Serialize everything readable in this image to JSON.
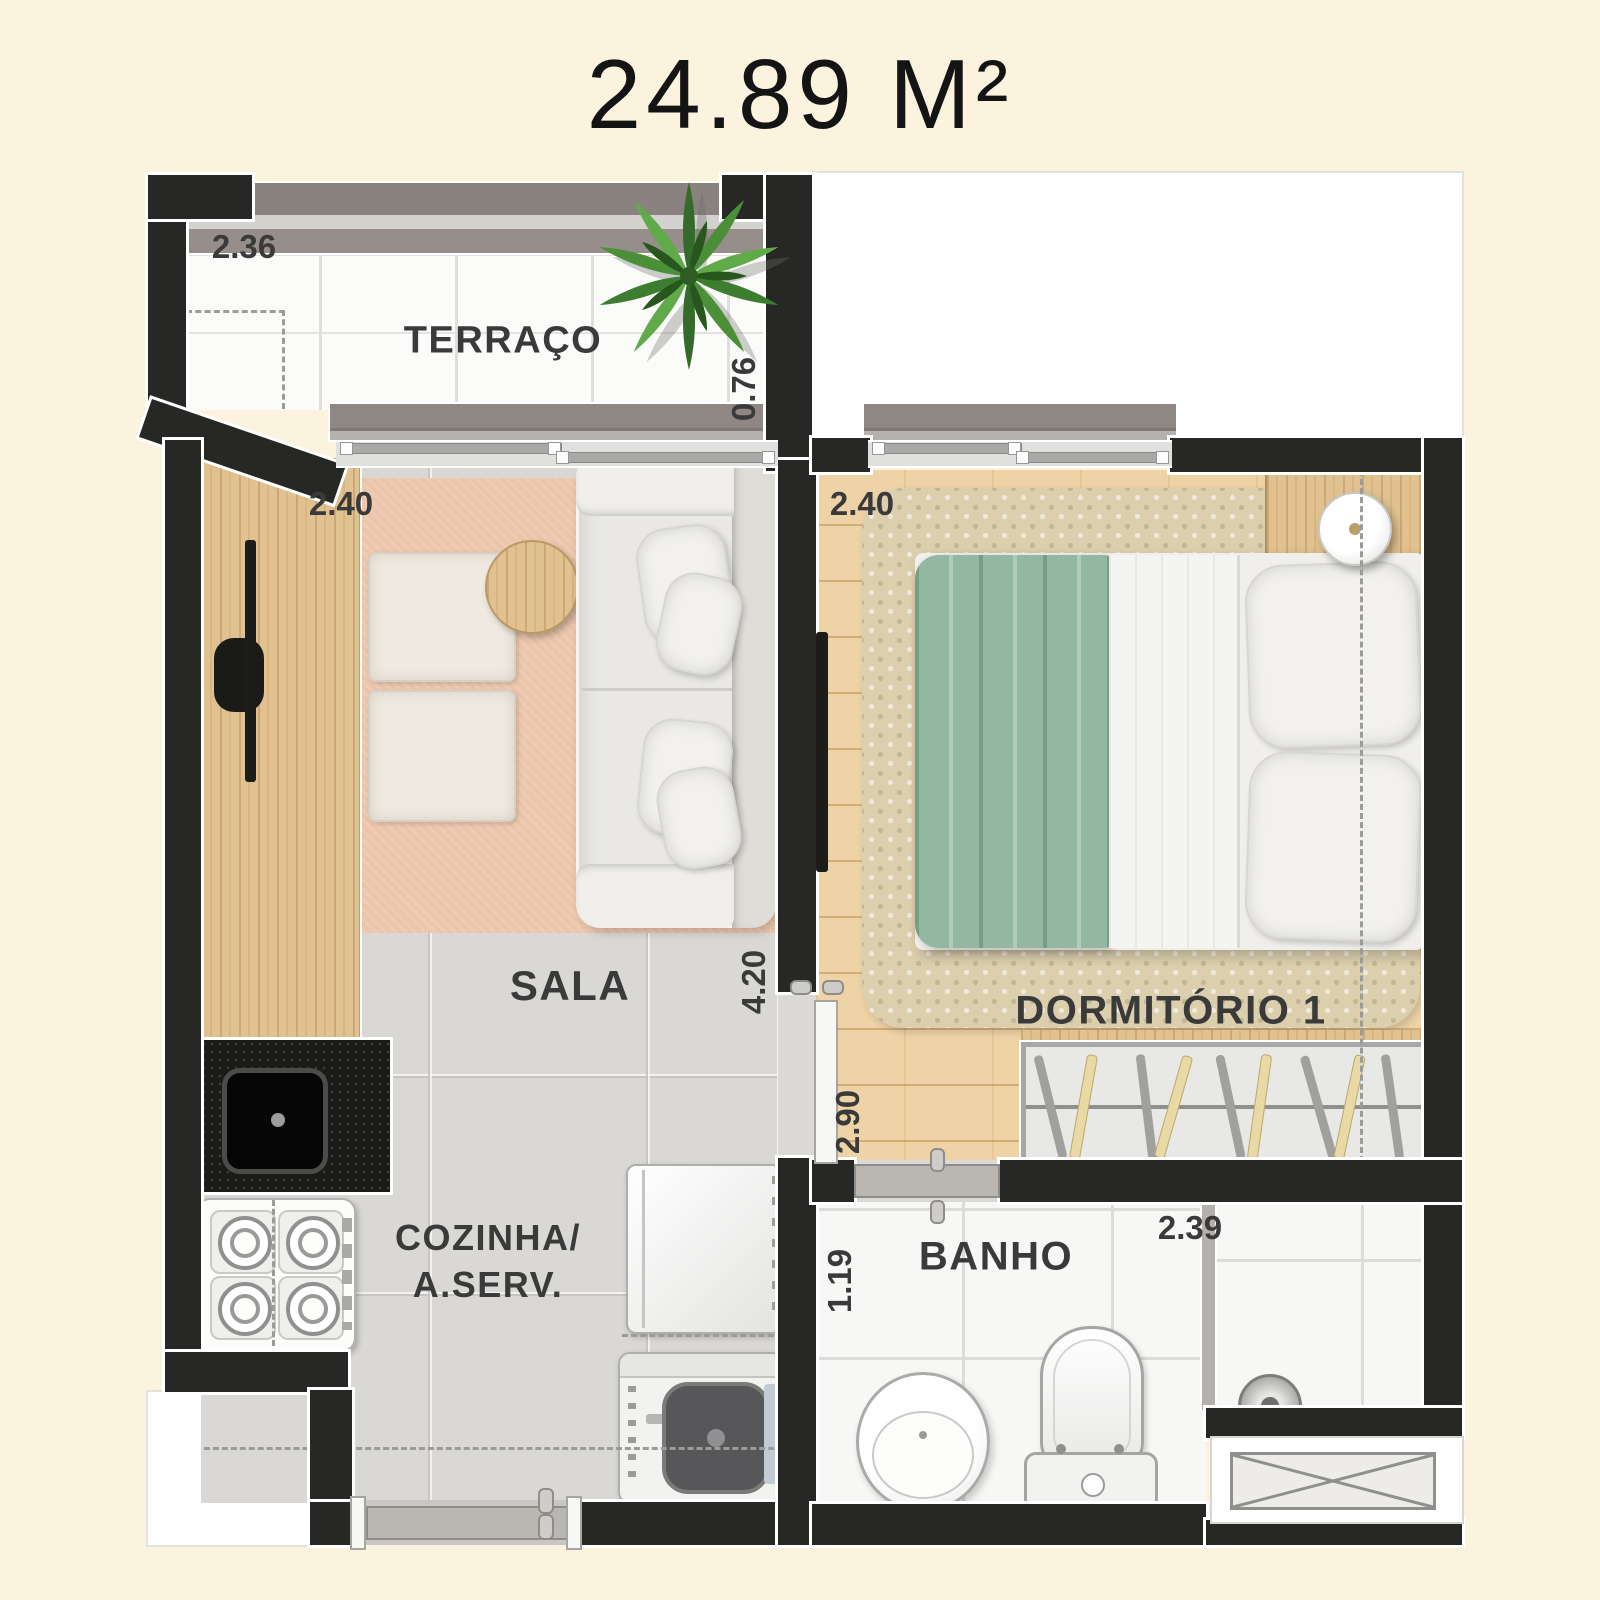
{
  "title": "24.89 M²",
  "rooms": {
    "terraco": {
      "label": "TERRAÇO",
      "dim_width": "2.36",
      "dim_depth": "0.76"
    },
    "sala": {
      "label": "SALA",
      "dim_width": "2.40",
      "dim_depth": "4.20"
    },
    "cozinha": {
      "label_line1": "COZINHA/",
      "label_line2": "A.SERV."
    },
    "dormitorio": {
      "label": "DORMITÓRIO 1",
      "dim_width": "2.40",
      "dim_depth": "2.90"
    },
    "banho": {
      "label": "BANHO",
      "dim_width": "2.39",
      "dim_depth": "1.19"
    }
  },
  "colors": {
    "background": "#fcf3de",
    "wall": "#272725",
    "rug_pink": "#ecc5ab",
    "rug_beige": "#dccfad",
    "blanket_green": "#93b7a0",
    "railing": "#8f8783",
    "counter": "#1a1a19",
    "label_text": "#3a3a3a"
  }
}
